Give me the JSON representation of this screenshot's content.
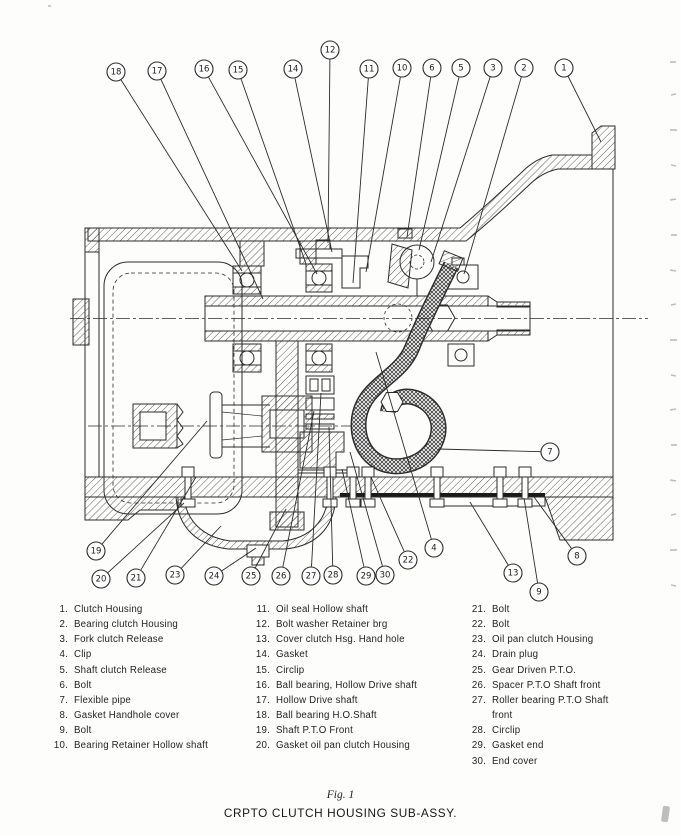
{
  "page": {
    "figure_caption": "Fig. 1",
    "figure_title": "CRPTO CLUTCH HOUSING SUB-ASSY."
  },
  "colors": {
    "ink": "#2b2b2b",
    "paper": "#fdfdfc"
  },
  "diagram": {
    "description": "Cross-section assembly drawing of CRPTO clutch housing with 30 numbered callout balloons",
    "callouts": [
      {
        "n": 1,
        "cx": 564,
        "cy": 68,
        "tx": 601,
        "ty": 142
      },
      {
        "n": 2,
        "cx": 524,
        "cy": 68,
        "tx": 464,
        "ty": 274
      },
      {
        "n": 3,
        "cx": 493,
        "cy": 68,
        "tx": 431,
        "ty": 262
      },
      {
        "n": 5,
        "cx": 461,
        "cy": 68,
        "tx": 419,
        "ty": 250
      },
      {
        "n": 6,
        "cx": 432,
        "cy": 68,
        "tx": 407,
        "ty": 237
      },
      {
        "n": 10,
        "cx": 402,
        "cy": 68,
        "tx": 366,
        "ty": 272
      },
      {
        "n": 11,
        "cx": 369,
        "cy": 69,
        "tx": 353,
        "ty": 283
      },
      {
        "n": 12,
        "cx": 330,
        "cy": 50,
        "tx": 328,
        "ty": 243
      },
      {
        "n": 14,
        "cx": 293,
        "cy": 69,
        "tx": 332,
        "ty": 252
      },
      {
        "n": 15,
        "cx": 238,
        "cy": 70,
        "tx": 306,
        "ty": 264
      },
      {
        "n": 16,
        "cx": 204,
        "cy": 69,
        "tx": 317,
        "ty": 274
      },
      {
        "n": 17,
        "cx": 157,
        "cy": 71,
        "tx": 263,
        "ty": 299
      },
      {
        "n": 18,
        "cx": 116,
        "cy": 72,
        "tx": 242,
        "ty": 271
      },
      {
        "n": 19,
        "cx": 96,
        "cy": 551,
        "tx": 207,
        "ty": 421
      },
      {
        "n": 20,
        "cx": 101,
        "cy": 579,
        "tx": 184,
        "ty": 503
      },
      {
        "n": 21,
        "cx": 136,
        "cy": 578,
        "tx": 196,
        "ty": 477
      },
      {
        "n": 23,
        "cx": 175,
        "cy": 575,
        "tx": 221,
        "ty": 526
      },
      {
        "n": 24,
        "cx": 214,
        "cy": 576,
        "tx": 256,
        "ty": 548
      },
      {
        "n": 25,
        "cx": 251,
        "cy": 576,
        "tx": 286,
        "ty": 509
      },
      {
        "n": 26,
        "cx": 281,
        "cy": 576,
        "tx": 314,
        "ty": 411
      },
      {
        "n": 27,
        "cx": 311,
        "cy": 576,
        "tx": 321,
        "ty": 393
      },
      {
        "n": 28,
        "cx": 333,
        "cy": 575,
        "tx": 329,
        "ty": 427
      },
      {
        "n": 29,
        "cx": 366,
        "cy": 576,
        "tx": 342,
        "ty": 469
      },
      {
        "n": 30,
        "cx": 385,
        "cy": 575,
        "tx": 350,
        "ty": 452
      },
      {
        "n": 22,
        "cx": 408,
        "cy": 560,
        "tx": 371,
        "ty": 477
      },
      {
        "n": 4,
        "cx": 434,
        "cy": 548,
        "tx": 376,
        "ty": 352
      },
      {
        "n": 13,
        "cx": 513,
        "cy": 573,
        "tx": 470,
        "ty": 502
      },
      {
        "n": 9,
        "cx": 539,
        "cy": 592,
        "tx": 524,
        "ty": 498
      },
      {
        "n": 8,
        "cx": 577,
        "cy": 556,
        "tx": 534,
        "ty": 497
      },
      {
        "n": 7,
        "cx": 550,
        "cy": 452,
        "tx": 438,
        "ty": 449
      }
    ]
  },
  "parts_list": {
    "columns": [
      {
        "items": [
          {
            "num": "1.",
            "label": "Clutch Housing"
          },
          {
            "num": "2.",
            "label": "Bearing clutch Housing"
          },
          {
            "num": "3.",
            "label": "Fork clutch Release"
          },
          {
            "num": "4.",
            "label": "Clip"
          },
          {
            "num": "5.",
            "label": "Shaft clutch Release"
          },
          {
            "num": "6.",
            "label": "Bolt"
          },
          {
            "num": "7.",
            "label": "Flexible pipe"
          },
          {
            "num": "8.",
            "label": "Gasket Handhole cover"
          },
          {
            "num": "9.",
            "label": "Bolt"
          },
          {
            "num": "10.",
            "label": "Bearing Retainer Hollow shaft"
          }
        ]
      },
      {
        "items": [
          {
            "num": "11.",
            "label": "Oil seal Hollow shaft"
          },
          {
            "num": "12.",
            "label": "Bolt washer Retainer brg"
          },
          {
            "num": "13.",
            "label": "Cover clutch Hsg. Hand hole"
          },
          {
            "num": "14.",
            "label": "Gasket"
          },
          {
            "num": "15.",
            "label": "Circlip"
          },
          {
            "num": "16.",
            "label": "Ball bearing, Hollow Drive shaft"
          },
          {
            "num": "17.",
            "label": "Hollow Drive shaft"
          },
          {
            "num": "18.",
            "label": "Ball bearing H.O.Shaft"
          },
          {
            "num": "19.",
            "label": "Shaft P.T.O Front"
          },
          {
            "num": "20.",
            "label": "Gasket oil pan clutch Housing"
          }
        ]
      },
      {
        "items": [
          {
            "num": "21.",
            "label": "Bolt"
          },
          {
            "num": "22.",
            "label": "Bolt"
          },
          {
            "num": "23.",
            "label": "Oil pan clutch Housing"
          },
          {
            "num": "24.",
            "label": "Drain plug"
          },
          {
            "num": "25.",
            "label": "Gear Driven P.T.O."
          },
          {
            "num": "26.",
            "label": "Spacer P.T.O Shaft front"
          },
          {
            "num": "27.",
            "label": "Roller bearing P.T.O Shaft\nfront"
          },
          {
            "num": "28.",
            "label": "Circlip"
          },
          {
            "num": "29.",
            "label": "Gasket end"
          },
          {
            "num": "30.",
            "label": "End cover"
          }
        ]
      }
    ]
  }
}
